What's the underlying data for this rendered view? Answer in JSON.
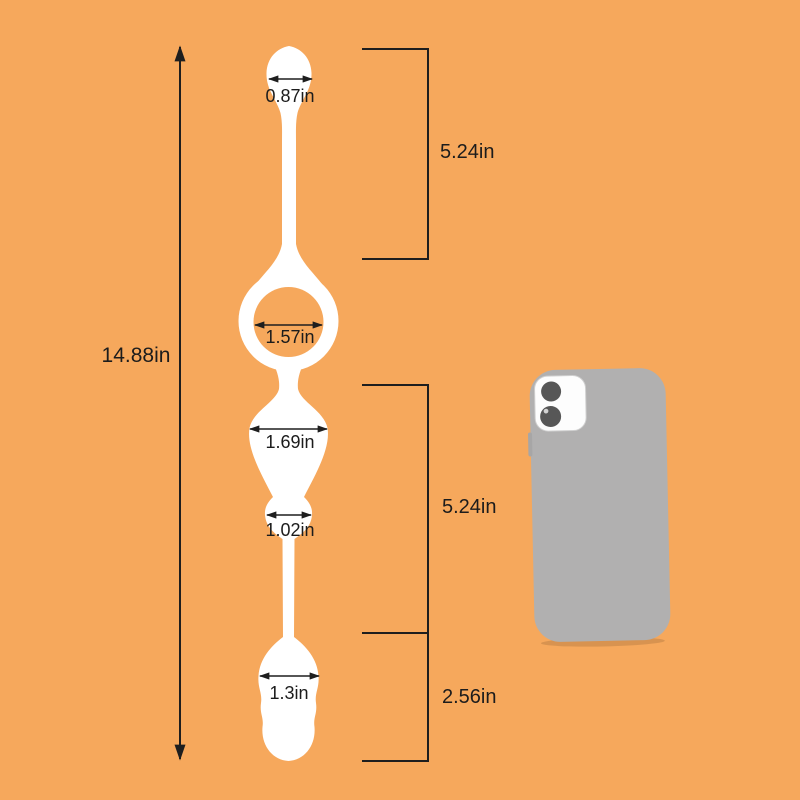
{
  "scene": {
    "background_color": "#f6a85c",
    "annotation_color": "#1e1e1e",
    "product_color": "#ffffff"
  },
  "product": {
    "measurements": {
      "total_length": "14.88in",
      "top_bead_width": "0.87in",
      "upper_section_length": "5.24in",
      "ring_inner_diameter": "1.57in",
      "large_bead_width": "1.69in",
      "small_bead_width": "1.02in",
      "lower_section_length": "5.24in",
      "bottom_bead_width": "1.3in",
      "tip_section_length": "2.56in"
    }
  },
  "size_reference": {
    "phone_body_color": "#b1b0b0",
    "camera_panel_color": "#fdfdfd",
    "lens_color": "#575757"
  }
}
